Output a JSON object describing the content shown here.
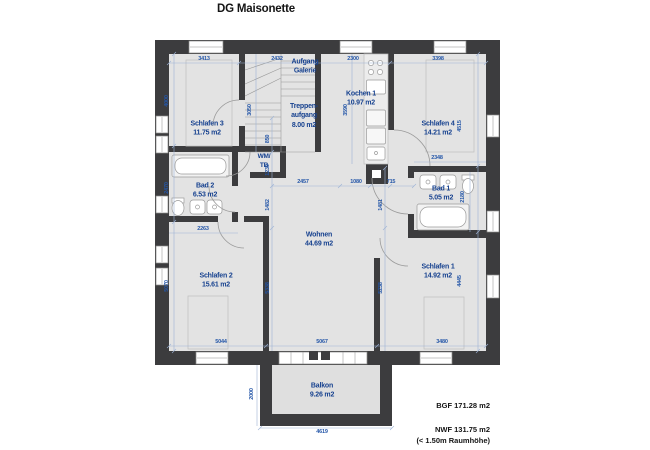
{
  "title": "DG Maisonette",
  "rooms": {
    "schlafen3": {
      "name": "Schlafen 3",
      "area": "11.75 m2"
    },
    "aufgang": {
      "line1": "Aufgang",
      "line2": "Galerie"
    },
    "treppe": {
      "line1": "Treppen-",
      "line2": "aufgang",
      "area": "8.00 m2"
    },
    "kochen": {
      "name": "Kochen 1",
      "area": "10.97 m2"
    },
    "schlafen4": {
      "name": "Schlafen 4",
      "area": "14.21 m2"
    },
    "wmtb": {
      "line1": "WM/",
      "line2": "TB"
    },
    "bad2": {
      "name": "Bad 2",
      "area": "6.53 m2"
    },
    "bad1": {
      "name": "Bad 1",
      "area": "5.05 m2"
    },
    "wohnen": {
      "name": "Wohnen",
      "area": "44.69 m2"
    },
    "schlafen2": {
      "name": "Schlafen 2",
      "area": "15.61 m2"
    },
    "schlafen1": {
      "name": "Schlafen 1",
      "area": "14.92 m2"
    },
    "balkon": {
      "name": "Balkon",
      "area": "9.26 m2"
    }
  },
  "dims": {
    "top_schlafen3": "3413",
    "top_treppe": "2432",
    "top_kochen": "2300",
    "top_schlafen4": "3398",
    "left_schlafen3": "4000",
    "left_bad2": "2470",
    "left_schlafen2": "5070",
    "right_schlafen4": "4515",
    "right_bad1": "2180",
    "right_schlafen1": "4445",
    "bottom_schlafen2": "5044",
    "bottom_wohnen": "5067",
    "bottom_schlafen1": "3480",
    "stair_height": "3050",
    "kochen_height": "3590",
    "chain_850": "850",
    "chain_1230": "1230",
    "chain_1482": "1482",
    "chain_5338": "5338",
    "chain_1481": "1481",
    "chain_5238": "5238",
    "mid_2457": "2457",
    "mid_1080": "1080",
    "mid_715": "715",
    "bad2_width": "2263",
    "bad1_width": "2348",
    "balkon_width": "4619",
    "balkon_depth": "2000"
  },
  "footer": {
    "bgf": "BGF 171.28 m2",
    "nwf": "NWF 131.75 m2",
    "note": "(< 1.50m Raumhöhe)"
  },
  "colors": {
    "wall": "#3c3c3e",
    "floor": "#e3e3e3",
    "room_label": "#16418f",
    "dim_text": "#2456a8",
    "dim_line": "#9db3d6"
  }
}
